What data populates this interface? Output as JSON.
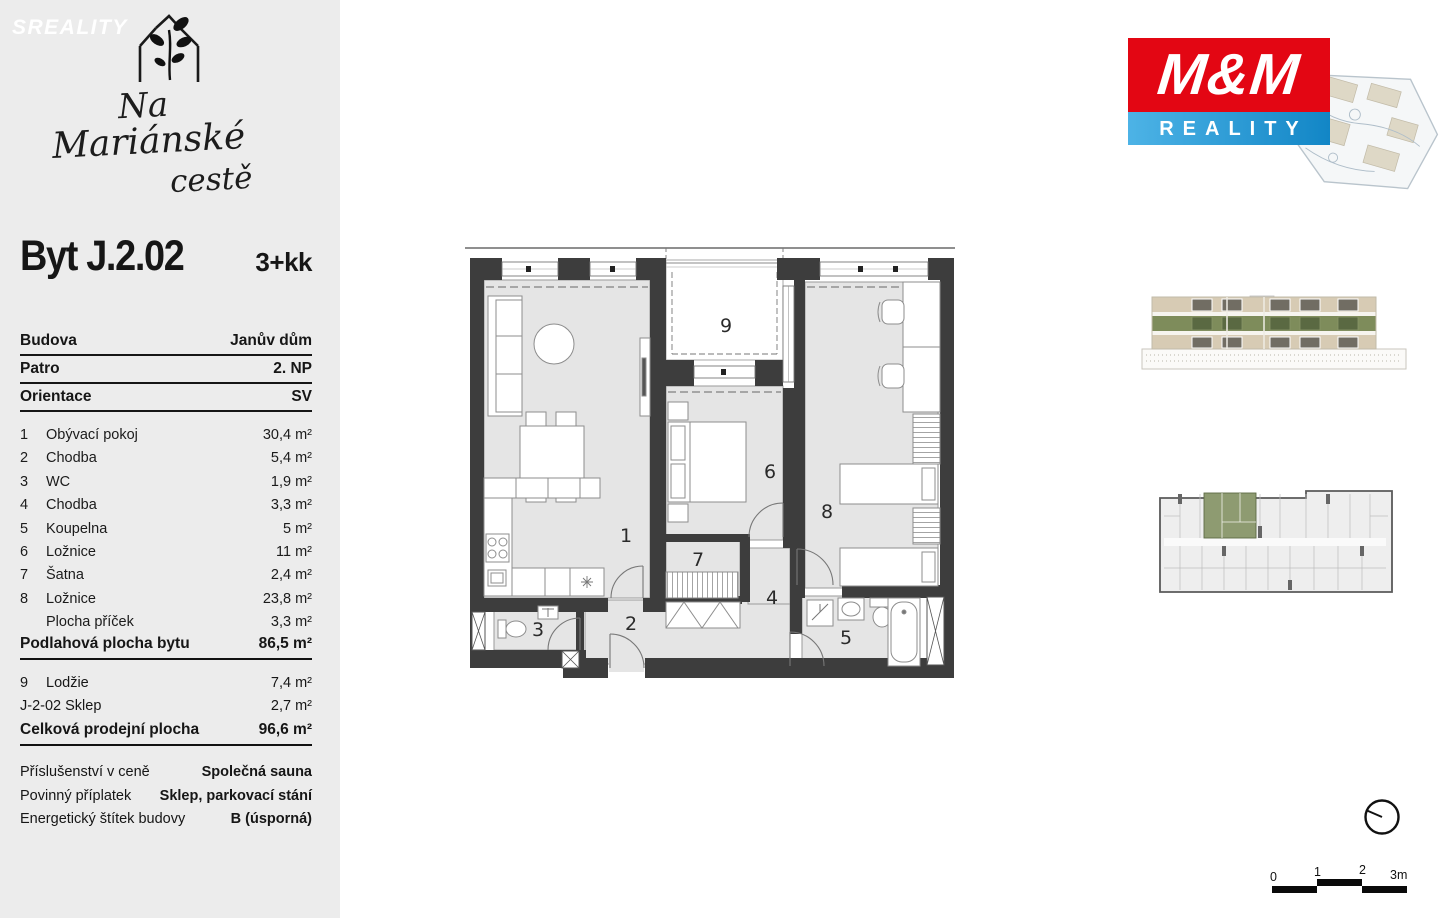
{
  "sidebar": {
    "watermark": "SREALITY",
    "logo": {
      "line1": "Na",
      "line2": "Mariánské",
      "line3": "cestě"
    },
    "title": "Byt J.2.02",
    "layout": "3+kk",
    "info_rows": [
      {
        "label": "Budova",
        "value": "Janův dům"
      },
      {
        "label": "Patro",
        "value": "2. NP"
      },
      {
        "label": "Orientace",
        "value": "SV"
      }
    ],
    "room_rows": [
      {
        "num": "1",
        "name": "Obývací pokoj",
        "area": "30,4 m²"
      },
      {
        "num": "2",
        "name": "Chodba",
        "area": "5,4 m²"
      },
      {
        "num": "3",
        "name": "WC",
        "area": "1,9 m²"
      },
      {
        "num": "4",
        "name": "Chodba",
        "area": "3,3 m²"
      },
      {
        "num": "5",
        "name": "Koupelna",
        "area": "5 m²"
      },
      {
        "num": "6",
        "name": "Ložnice",
        "area": "11 m²"
      },
      {
        "num": "7",
        "name": "Šatna",
        "area": "2,4 m²"
      },
      {
        "num": "8",
        "name": "Ložnice",
        "area": "23,8 m²"
      },
      {
        "num": "",
        "name": "Plocha příček",
        "area": "3,3 m²"
      }
    ],
    "subtotal": {
      "label": "Podlahová plocha bytu",
      "value": "86,5 m²"
    },
    "extra_rows": [
      {
        "num": "9",
        "name": "Lodžie",
        "area": "7,4 m²"
      },
      {
        "num": "",
        "name": "J-2-02 Sklep",
        "area": "2,7 m²"
      }
    ],
    "total": {
      "label": "Celková prodejní plocha",
      "value": "96,6 m²"
    },
    "notes": [
      {
        "label": "Příslušenství v ceně",
        "value": "Společná sauna"
      },
      {
        "label": "Povinný příplatek",
        "value": "Sklep, parkovací stání"
      },
      {
        "label": "Energetický štítek budovy",
        "value": "B (úsporná)"
      }
    ]
  },
  "floorplan": {
    "labels": {
      "r1": "1",
      "r2": "2",
      "r3": "3",
      "r4": "4",
      "r5": "5",
      "r6": "6",
      "r7": "7",
      "r8": "8",
      "r9": "9"
    }
  },
  "agency": {
    "top": "M&M",
    "bottom": "REALITY"
  },
  "scalebar": {
    "t0": "0",
    "t1": "1",
    "t2": "2",
    "t3": "3m"
  },
  "colors": {
    "mm_red": "#e30613",
    "mm_blue": "#2095d5",
    "highlight_green": "#8e9b71",
    "elevation_green": "#7e8c5b",
    "wall": "#3d3d3d",
    "sidebar_bg": "#ececec"
  }
}
